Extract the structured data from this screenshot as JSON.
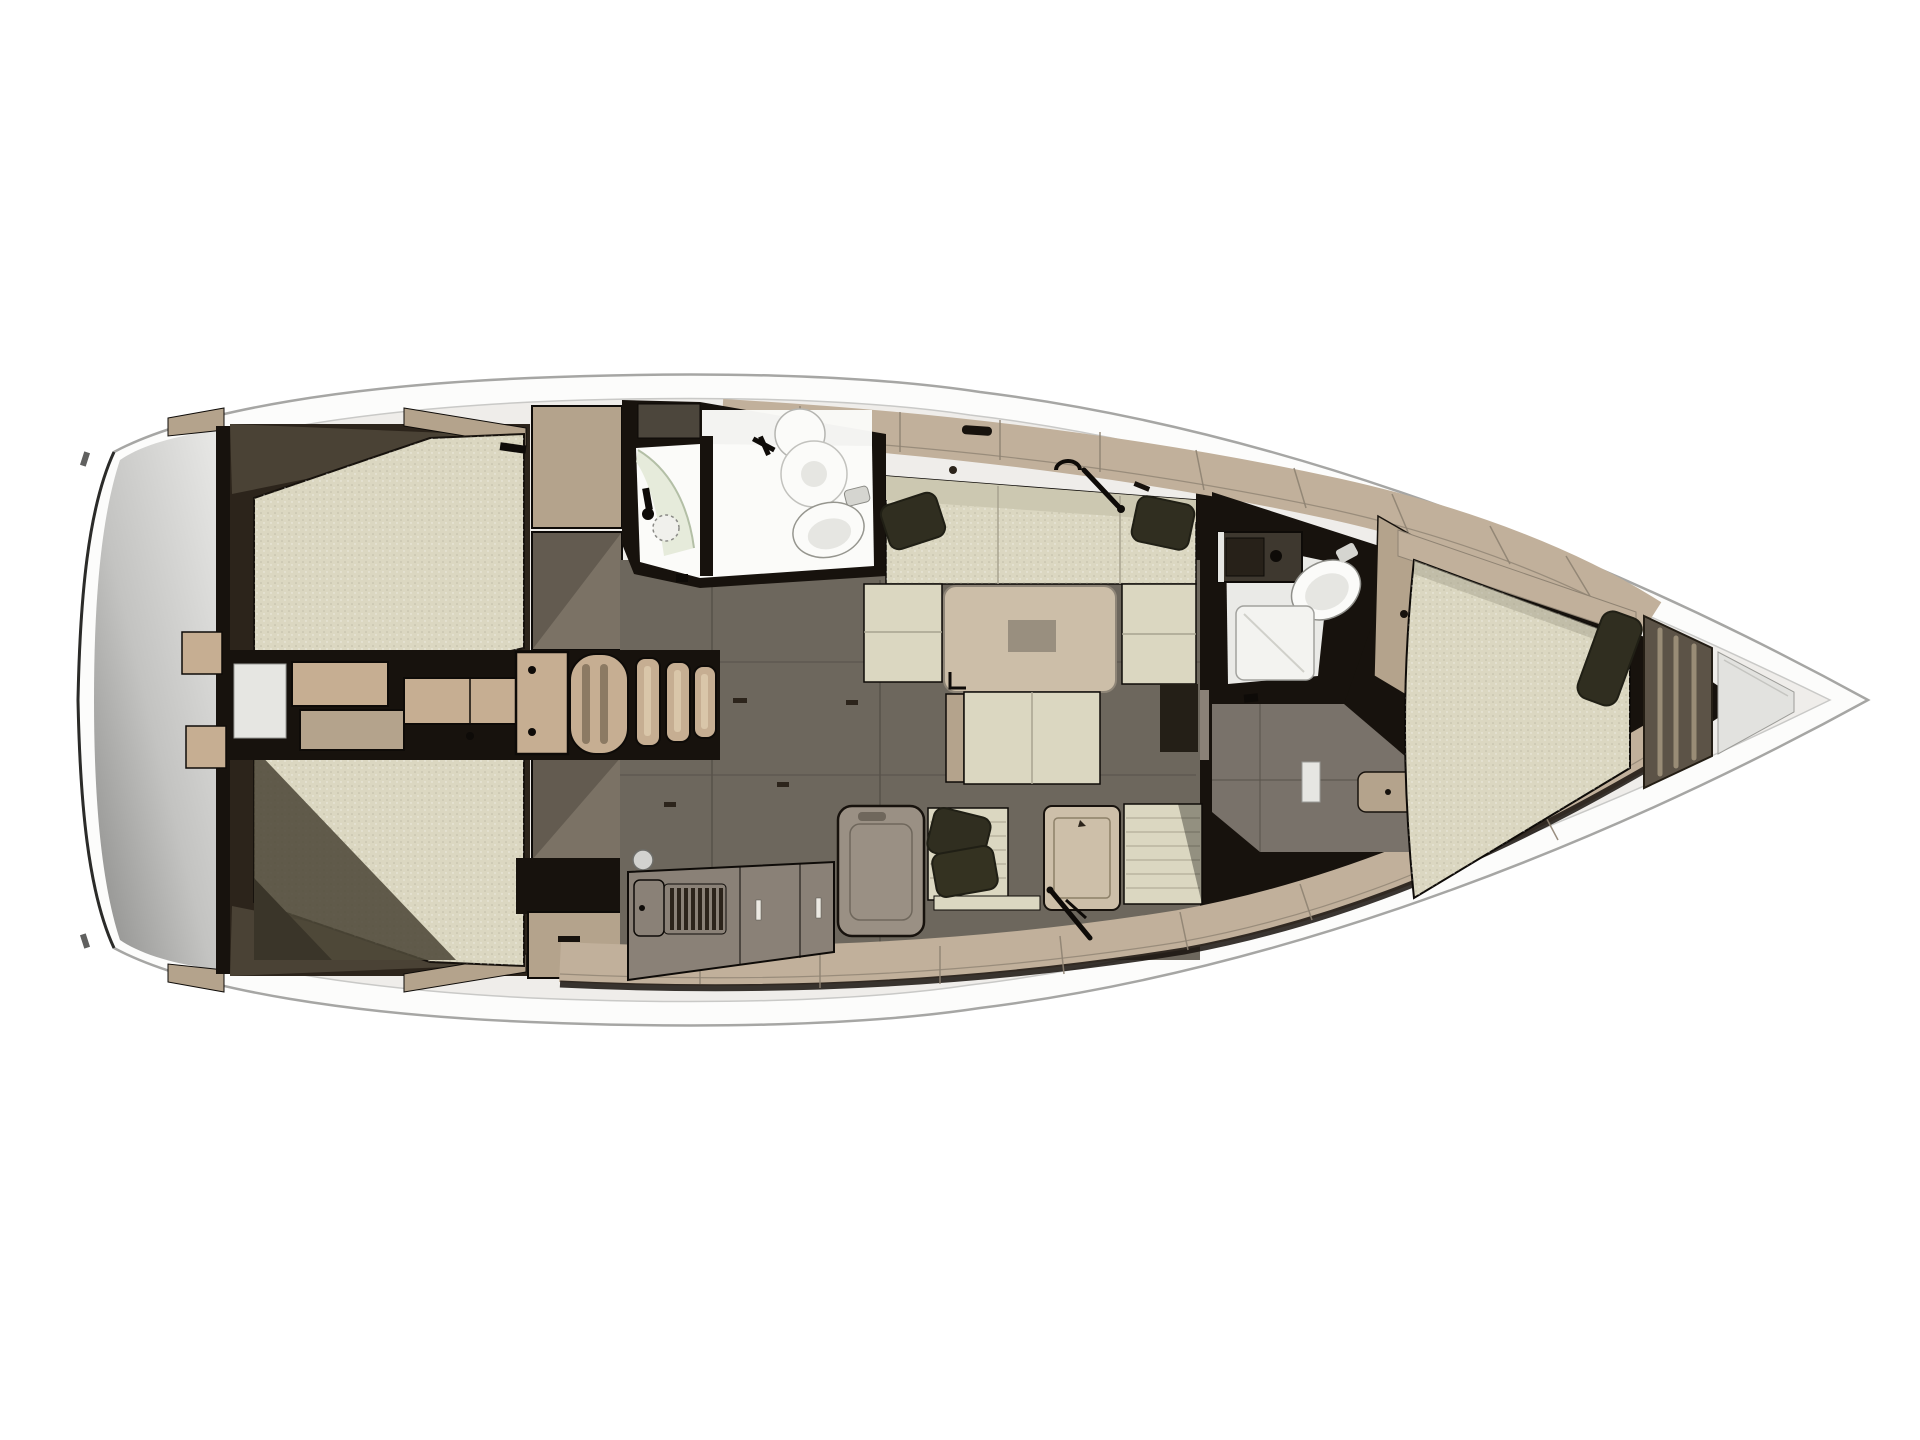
{
  "diagram": {
    "kind": "sailing-yacht-interior-floor-plan-top-view",
    "view": "top-down",
    "orientation_bow": "right",
    "orientation_stern": "left"
  },
  "colors": {
    "bg": "#ffffff",
    "hullFill": "#fcfcfb",
    "hullStroke": "#a6a6a4",
    "hullEdgeDark": "#2b2b29",
    "rimFill": "#efedea",
    "rimLine": "#c9c9c7",
    "transomLight": "#eaeae8",
    "transomMid": "#c3c3c1",
    "transomDark": "#8b8b89",
    "wallDark": "#17120d",
    "wallBrown": "#2c241b",
    "wallOlive": "#4a4235",
    "cream": "#dbd7c1",
    "creamBack": "#ccc8b1",
    "creamSeam": "#a8a390",
    "creamShadow": "#4e4939",
    "creamShadowDeep": "#3a3529",
    "woodLight": "#c6ae92",
    "woodMid": "#b4a38c",
    "woodPale": "#cdbfa9",
    "woodDeck": "#c1b09b",
    "woodSeam": "#8f8373",
    "woodSlot": "#8c7a63",
    "woodSlotLight": "#d9c6a9",
    "tableTop": "#ccbea8",
    "tableInset": "#998f7f",
    "counterGray": "#8a8177",
    "counterDark": "#7b7265",
    "applianceGray": "#9a9084",
    "floorDark": "#6d675d",
    "floorMid": "#79726a",
    "floorSeam": "#57524a",
    "white": "#fbfbf9",
    "whiteShade": "#e6e6e2",
    "showerGreen": "#e2e8d6",
    "pillow": "#302e20",
    "pillowDark": "#201f15",
    "slatPanel": "#5c5347",
    "slatLight": "#998c76",
    "anchorGray": "#e2e2df",
    "black": "#0e0b08",
    "grayShelf": "#4c463c"
  },
  "legend": {
    "rooms": [
      {
        "id": "swim-platform",
        "label": "stern swim platform"
      },
      {
        "id": "aft-cabin-port",
        "label": "aft double cabin port"
      },
      {
        "id": "aft-cabin-starboard",
        "label": "aft double cabin starboard"
      },
      {
        "id": "engine-compartment",
        "label": "engine compartment and companionway steps"
      },
      {
        "id": "aft-head",
        "label": "aft head with shower basin and toilet"
      },
      {
        "id": "saloon",
        "label": "saloon with settees table and bench"
      },
      {
        "id": "galley",
        "label": "galley with lockers vented fridge and counters"
      },
      {
        "id": "forward-head",
        "label": "forward head with basin toilet and shower"
      },
      {
        "id": "forward-cabin",
        "label": "forward v-berth cabin"
      },
      {
        "id": "anchor-locker",
        "label": "bow anchor locker"
      }
    ]
  }
}
